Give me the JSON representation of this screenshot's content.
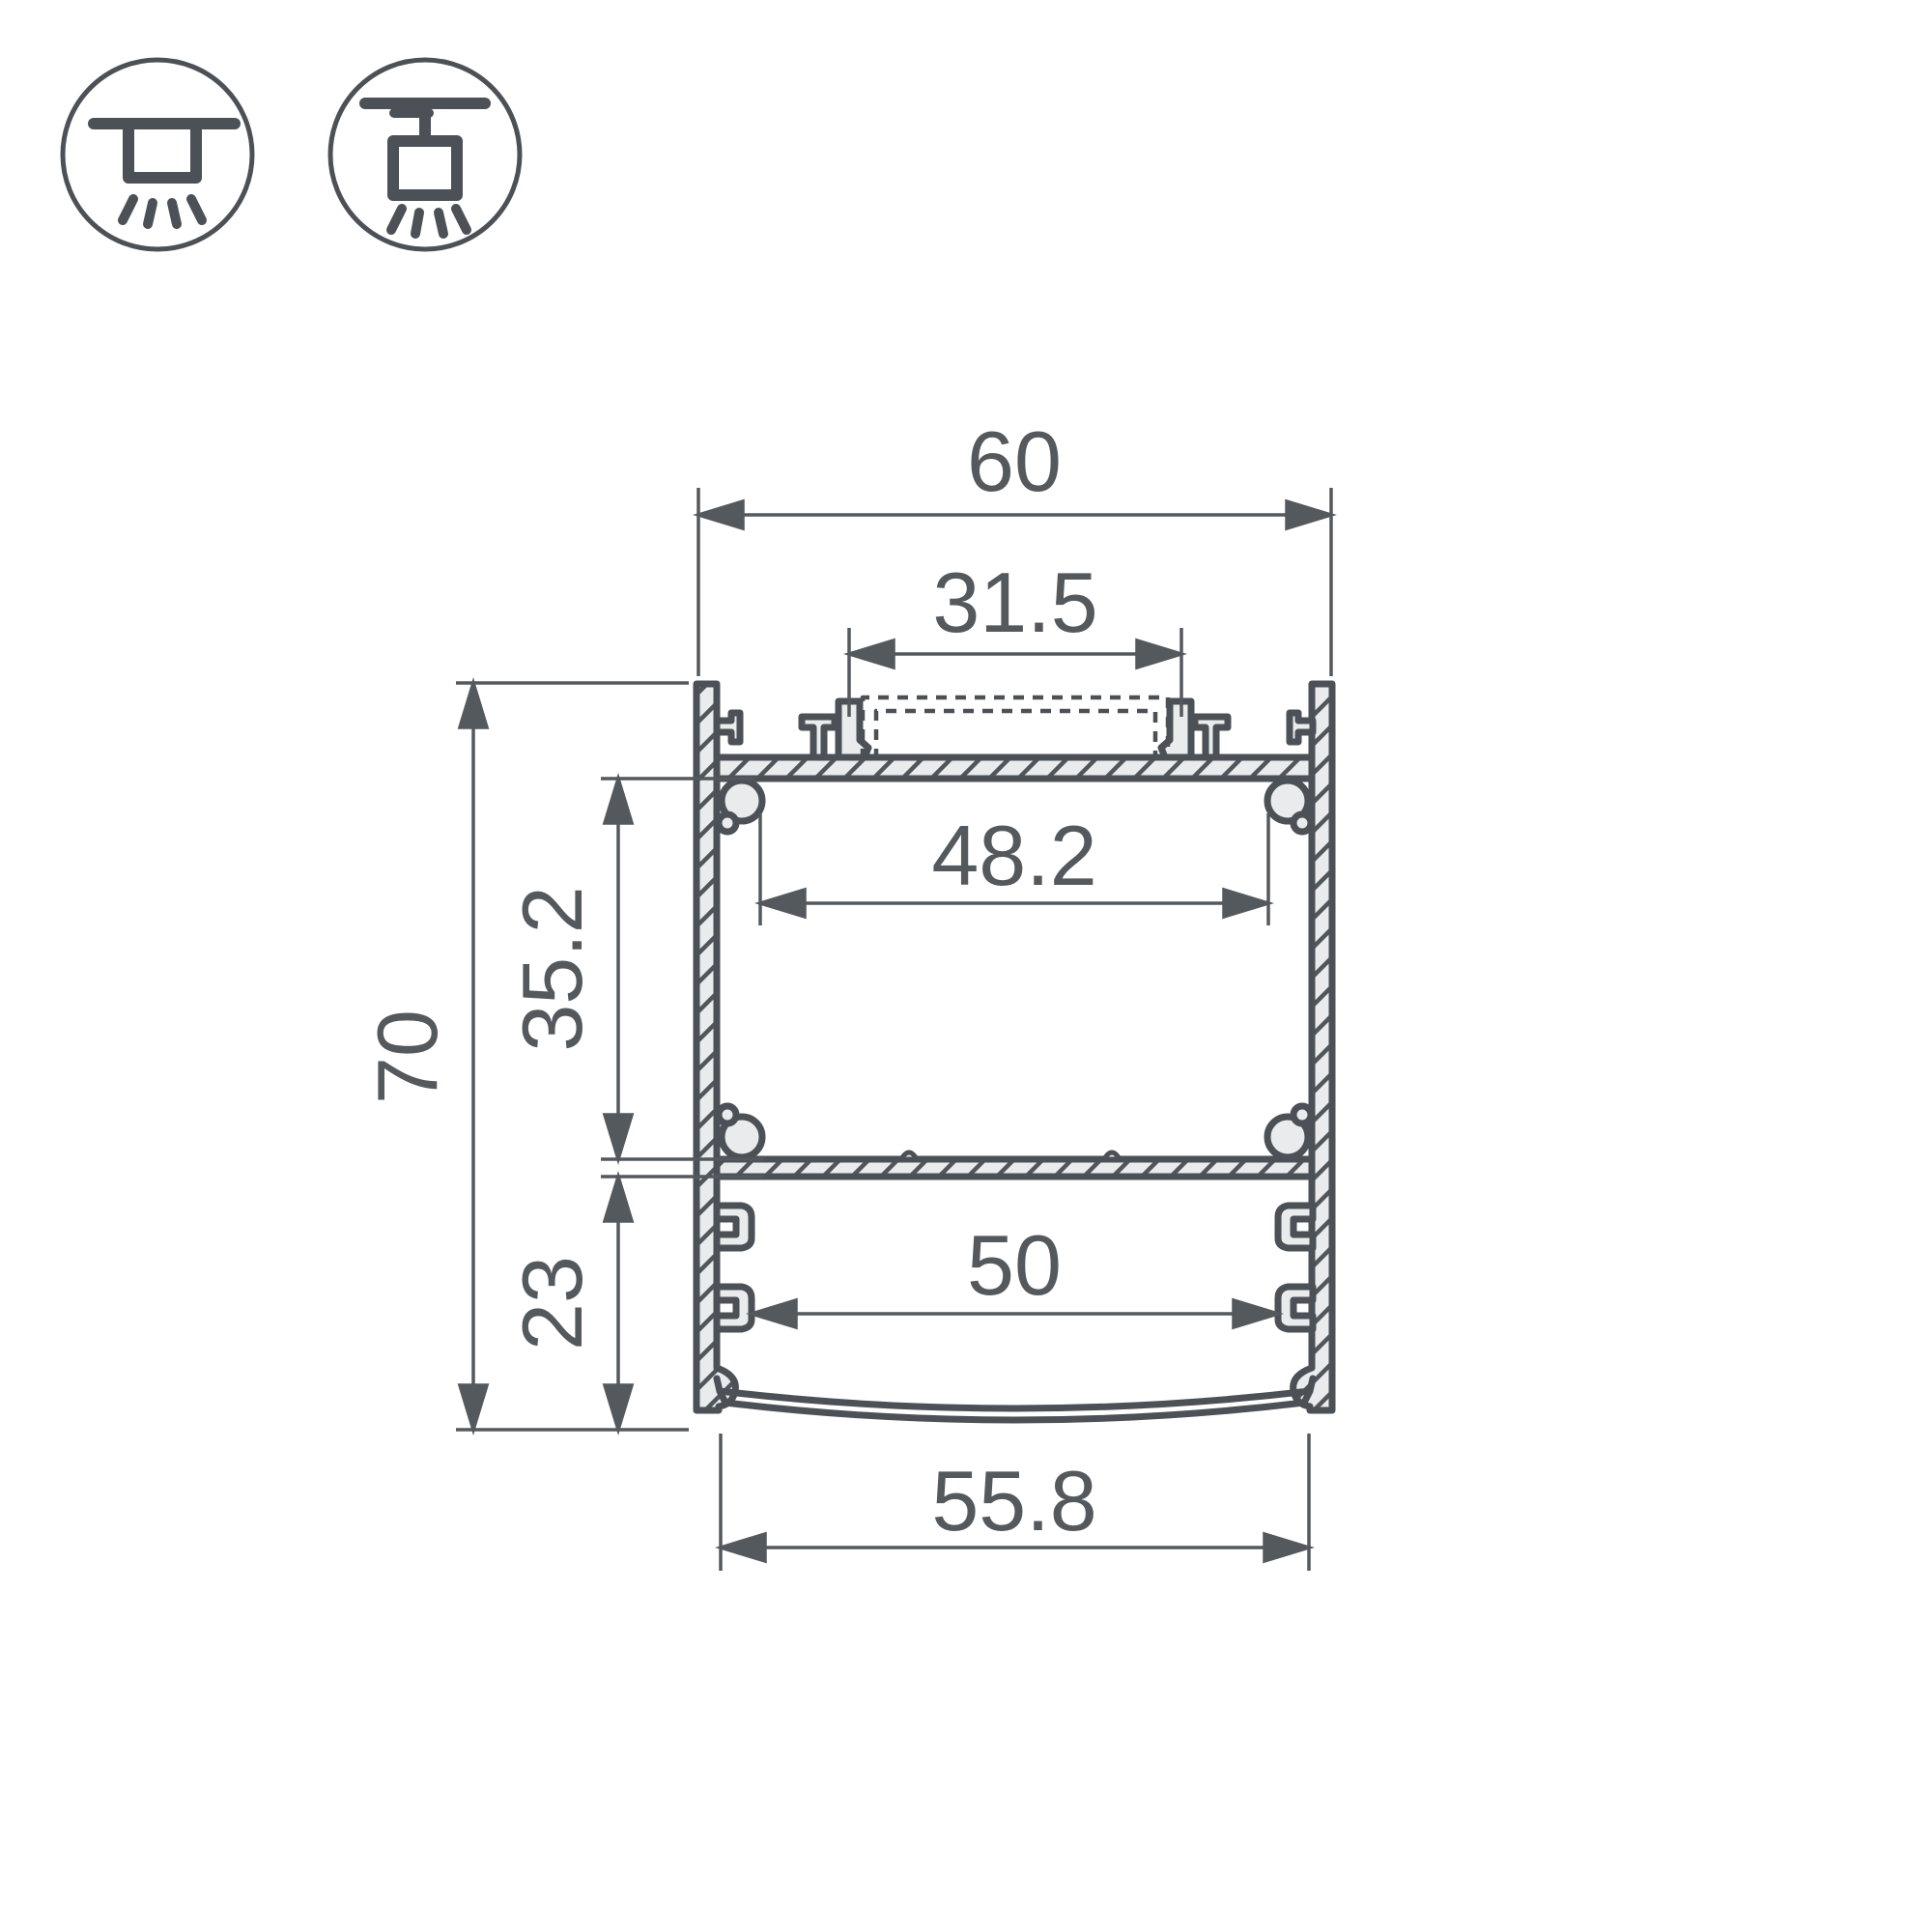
{
  "drawing": {
    "kind": "LED profile cross-section drawing",
    "dimensions": {
      "top_width": "60",
      "top_cover_width": "31.5",
      "upper_chamber_width": "48.2",
      "upper_chamber_height": "35.2",
      "overall_height": "70",
      "lower_chamber_height": "23",
      "lower_chamber_width": "50",
      "bottom_width": "55.8"
    },
    "icons": {
      "surface_mount": "surface-mount-icon",
      "pendant_mount": "pendant-mount-icon"
    },
    "colors": {
      "outline": "#4b5156",
      "metal_fill": "#e9ebed",
      "dimension": "#54595e",
      "background": "#ffffff"
    }
  }
}
